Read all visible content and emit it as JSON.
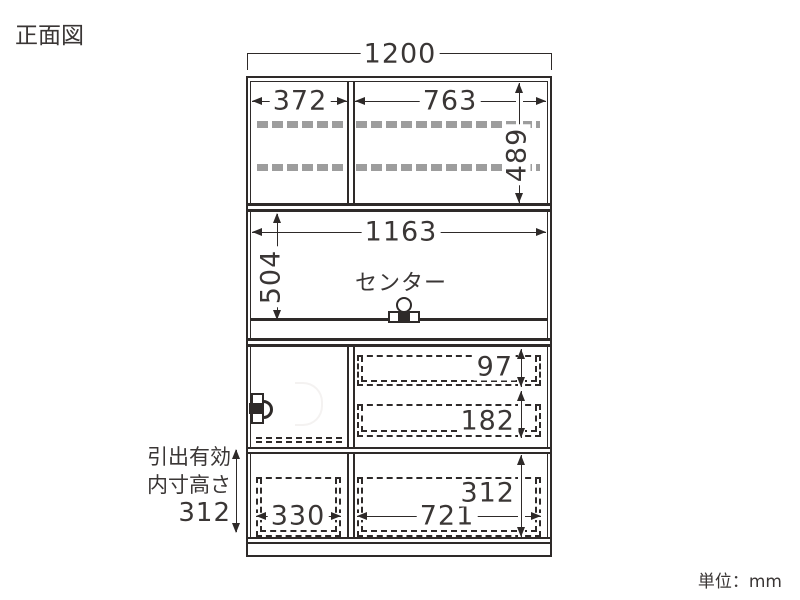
{
  "page": {
    "title": "正面図",
    "unit_label": "単位：mm"
  },
  "drawing": {
    "type": "furniture-front-elevation",
    "dims": {
      "overall_width": "1200",
      "upper_left_inner_width": "372",
      "upper_right_inner_width": "763",
      "upper_inner_height": "489",
      "middle_inner_width": "1163",
      "middle_inner_height": "504",
      "top_drawer_height": "97",
      "middle_drawer_height": "182",
      "bottom_drawer_height": "312",
      "bottom_left_drawer_width": "330",
      "bottom_right_drawer_width": "721"
    },
    "labels": {
      "center": "センター",
      "drawer_note_line1": "引出有効",
      "drawer_note_line2": "内寸高さ",
      "drawer_note_line3": "312"
    },
    "icons": {
      "outlet": "outlet-icon",
      "lock": "lock-icon"
    },
    "colors": {
      "line": "#2e2a29",
      "text": "#3a3635",
      "shelf_bar": "#9d9d9d",
      "background": "#ffffff"
    }
  }
}
